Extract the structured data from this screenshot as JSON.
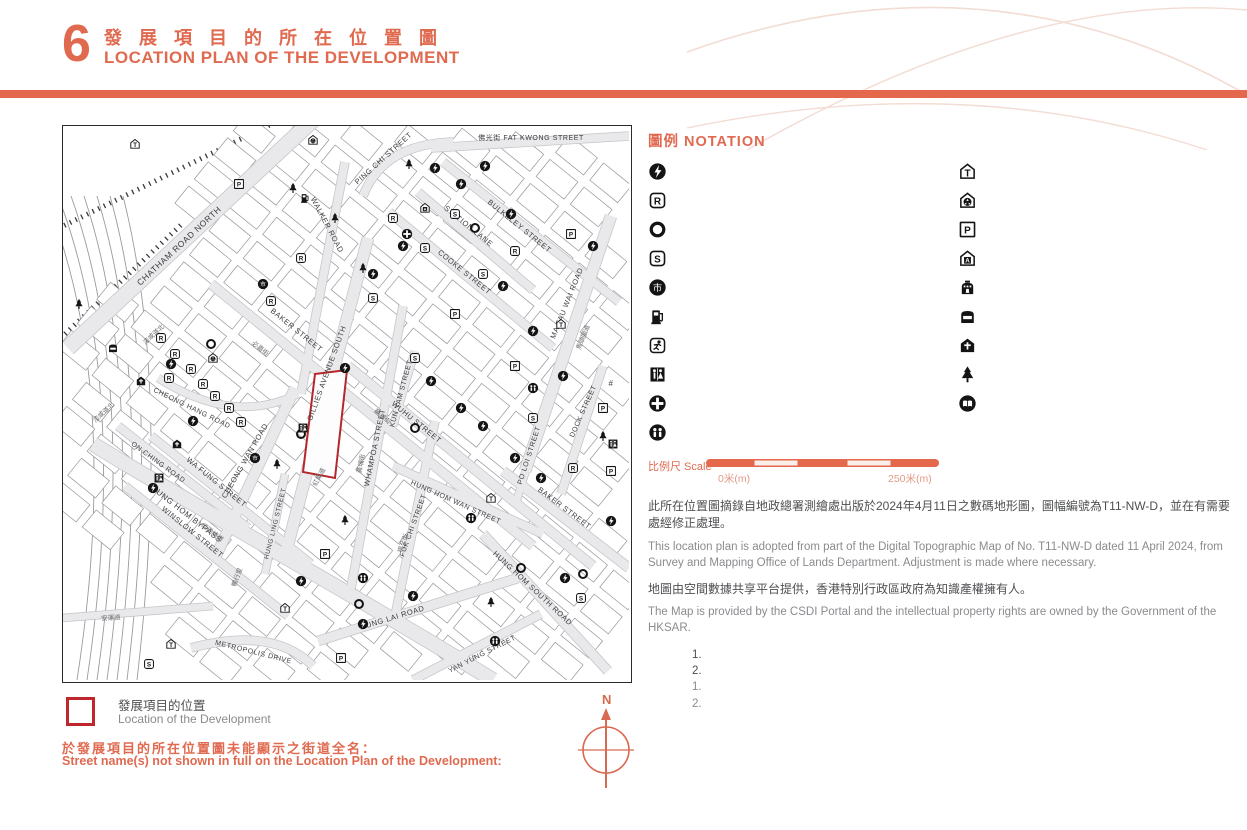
{
  "page": {
    "number": "6",
    "title_zh": "發 展 項 目 的 所 在 位 置 圖",
    "title_en": "LOCATION PLAN OF THE DEVELOPMENT"
  },
  "colors": {
    "accent": "#e06a50",
    "bar": "#e4694c",
    "site_red": "#b5272b",
    "key_red": "#c0272d"
  },
  "notation": {
    "title": "圖例 NOTATION",
    "columns": [
      [
        {
          "icon": "power",
          "zh": "發電廠（包括電力分站）",
          "en": "Power Plant (including Electricity Sub-stations)"
        },
        {
          "icon": "religious",
          "zh": "宗教場所（包括教堂、廟宇及祠堂）",
          "en": "Religious Institution (including Church, Temple and Tsz Tong)"
        },
        {
          "icon": "utility",
          "zh": "公用事業設施裝置",
          "en": "Public Utility Installation"
        },
        {
          "icon": "school",
          "zh": "學校（包括幼稚園）",
          "en": "School (including Kindergarten)"
        },
        {
          "icon": "market",
          "zh": "市場（包括濕貨市場及批發市場）",
          "en": "Market (including Wet Market and Wholesale Market)"
        },
        {
          "icon": "petrol",
          "zh": "油站",
          "en": "Petrol Filling Station"
        },
        {
          "icon": "sports",
          "zh": "體育設施（包括運動場及游泳池）",
          "en": "Sports Facilities (including Sports Ground and Swimming Pool)"
        },
        {
          "icon": "toilet",
          "zh": "公廁",
          "en": "Public Convenience"
        },
        {
          "icon": "clinic",
          "zh": "診療所",
          "en": "Clinic"
        },
        {
          "icon": "welfare",
          "zh": "社會福利設施（包括老人中心及弱智人士護理院）",
          "en": "Social Welfare Facilities (including Elderly Centre and Home for the Mentally Disabled)"
        }
      ],
      [
        {
          "icon": "transport",
          "zh": "公共交通總站（包括鐵路車站）",
          "en": "Public Transport Terminal (including Rail Station)"
        },
        {
          "icon": "refuse",
          "zh": "垃圾收集站",
          "en": "Refuse Collection Point"
        },
        {
          "icon": "carpark",
          "zh": "公眾停車場（包括貨車停泊處）",
          "en": "Public Carpark (including Lorry Park)"
        },
        {
          "icon": "addiction",
          "zh": "戒毒院所",
          "en": "Addiction Treatment Centre"
        },
        {
          "icon": "columbarium",
          "zh": "骨灰龕",
          "en": "Columbarium"
        },
        {
          "icon": "mortuary",
          "zh": "殮房",
          "en": "Mortuary"
        },
        {
          "icon": "funeral",
          "zh": "殯儀館",
          "en": "Funeral Parlour"
        },
        {
          "icon": "park",
          "zh": "公園",
          "en": "Public Park"
        },
        {
          "icon": "library",
          "zh": "圖書館",
          "en": "Library"
        }
      ]
    ]
  },
  "scale": {
    "label": "比例尺 Scale",
    "start": "0米(m)",
    "end": "250米(m)"
  },
  "source": {
    "para1_zh": "此所在位置圖摘錄自地政總署測繪處出版於2024年4月11日之數碼地形圖，圖幅編號為T11-NW-D，並在有需要處經修正處理。",
    "para1_en": "This location plan is adopted from part of the Digital Topographic Map of No. T11-NW-D dated 11 April 2024, from Survey and Mapping Office of Lands Department. Adjustment is made where necessary.",
    "para2_zh": "地圖由空間數據共享平台提供，香港特別行政區政府為知識產權擁有人。",
    "para2_en": "The Map is provided by the CSDI Portal and the intellectual property rights are owned by the Government of the HKSAR."
  },
  "notes": {
    "label_zh": "備註：",
    "label_en": "Notes:",
    "zh": [
      "因技術性問題，此所在位置圖顯示的範圍超過《一手住宅物業銷售條例》的規定。",
      "賣方建議準買家到發展項目作實地考察，以對發展項目、其周邊地區環境及附近的公共設施有較佳了解。"
    ],
    "en": [
      "Due to technical reasons, this location plan has shown more than the area required under the Residential Properties (First-hand Sales) Ordinance.",
      "The Vendor advises prospective purchasers to conduct an on-site visit for a better understanding of the Development, its surrounding environment and the public facilities nearby."
    ]
  },
  "dev_location": {
    "zh": "發展項目的位置",
    "en": "Location of the Development"
  },
  "street_names": {
    "heading_zh": "於發展項目的所在位置圖未能顯示之街道全名：",
    "heading_en": "Street name(s) not shown in full on the Location Plan of the Development:",
    "columns": [
      [
        {
          "zh": "#德民街",
          "en": "Tak Man Street"
        },
        {
          "zh": "暢行里",
          "en": "Cheong Hang Lane"
        },
        {
          "zh": "孖庶街",
          "en": "Marsh Street"
        },
        {
          "zh": "湖光街",
          "en": "Wu Kwong Street"
        }
      ],
      [
        {
          "zh": "紅樂道",
          "en": "Hung Lok Road"
        },
        {
          "zh": "必嘉圍",
          "en": "Baker Court"
        },
        {
          "zh": "大沽街",
          "en": "Taku Street"
        },
        {
          "zh": "安運道",
          "en": "On Wan Road"
        }
      ],
      [
        {
          "zh": "暢通道南",
          "en": "Cheong Tung Road South"
        },
        {
          "zh": "馬來街",
          "en": "Malacca Street"
        },
        {
          "zh": "明安街",
          "en": "Ming On Street"
        }
      ]
    ]
  },
  "compass": {
    "label": "N"
  },
  "map": {
    "streets": [
      {
        "t": "CHATHAM ROAD NORTH",
        "x": 118,
        "y": 122,
        "r": -43,
        "s": 8.5
      },
      {
        "t": "PING CHI STREET",
        "x": 322,
        "y": 34,
        "r": -42,
        "s": 7.5
      },
      {
        "t": "佛光街 FAT KWONG STREET",
        "x": 468,
        "y": 14,
        "r": 0,
        "s": 7
      },
      {
        "t": "BULKELEY STREET",
        "x": 455,
        "y": 102,
        "r": 39,
        "s": 7.5
      },
      {
        "t": "COOKE STREET",
        "x": 400,
        "y": 148,
        "r": 39,
        "s": 7.5
      },
      {
        "t": "BAKER STREET",
        "x": 232,
        "y": 206,
        "r": 39,
        "s": 7.5
      },
      {
        "t": "STATION LANE",
        "x": 404,
        "y": 102,
        "r": 39,
        "s": 7.5
      },
      {
        "t": "WALKER ROAD",
        "x": 262,
        "y": 100,
        "r": 62,
        "s": 7.5
      },
      {
        "t": "WUHU STREET",
        "x": 352,
        "y": 298,
        "r": 39,
        "s": 7.5
      },
      {
        "t": "WA FUNG STREET",
        "x": 152,
        "y": 358,
        "r": 39,
        "s": 7.5
      },
      {
        "t": "WINSLOW STREET",
        "x": 128,
        "y": 408,
        "r": 39,
        "s": 7.5
      },
      {
        "t": "KUN YAM STREET",
        "x": 340,
        "y": 268,
        "r": -75,
        "s": 7
      },
      {
        "t": "MA TAU WAI ROAD",
        "x": 506,
        "y": 178,
        "r": -68,
        "s": 7.5
      },
      {
        "t": "DOCK STREET",
        "x": 522,
        "y": 286,
        "r": -66,
        "s": 7
      },
      {
        "t": "GILLIES AVENUE SOUTH",
        "x": 266,
        "y": 248,
        "r": -70,
        "s": 7.5
      },
      {
        "t": "WHAMPOA STREET",
        "x": 314,
        "y": 322,
        "r": -78,
        "s": 7.5
      },
      {
        "t": "FUK CHI STREET",
        "x": 352,
        "y": 400,
        "r": -70,
        "s": 7
      },
      {
        "t": "PO LOI STREET",
        "x": 468,
        "y": 330,
        "r": -72,
        "s": 7
      },
      {
        "t": "BAKER STREET",
        "x": 500,
        "y": 384,
        "r": 37,
        "s": 7.5
      },
      {
        "t": "HUNG HOM WAN STREET",
        "x": 392,
        "y": 378,
        "r": 24,
        "s": 7
      },
      {
        "t": "HUNG HOM SOUTH ROAD",
        "x": 468,
        "y": 464,
        "r": 43,
        "s": 7.5
      },
      {
        "t": "HUNG LAI ROAD",
        "x": 330,
        "y": 494,
        "r": -17,
        "s": 7.5
      },
      {
        "t": "YAN YUNG STREET",
        "x": 420,
        "y": 530,
        "r": -27,
        "s": 7
      },
      {
        "t": "METROPOLIS DRIVE",
        "x": 190,
        "y": 528,
        "r": 14,
        "s": 7
      },
      {
        "t": "HUNG HOM BYPASS",
        "x": 122,
        "y": 390,
        "r": 38,
        "s": 8
      },
      {
        "t": "ON CHING ROAD",
        "x": 94,
        "y": 338,
        "r": 36,
        "s": 7
      },
      {
        "t": "CHEONG WAN ROAD",
        "x": 184,
        "y": 336,
        "r": -60,
        "s": 7.5
      },
      {
        "t": "CHEONG HANG ROAD",
        "x": 128,
        "y": 284,
        "r": 26,
        "s": 7
      },
      {
        "t": "HUNG LING STREET",
        "x": 214,
        "y": 398,
        "r": -76,
        "s": 6.5
      },
      {
        "t": "#",
        "x": 548,
        "y": 260,
        "r": 0,
        "s": 8
      }
    ],
    "streets_zh": [
      {
        "t": "漆咸道北",
        "x": 92,
        "y": 210,
        "r": -43,
        "s": 6.5
      },
      {
        "t": "漆咸道北",
        "x": 42,
        "y": 288,
        "r": -43,
        "s": 6.5
      },
      {
        "t": "必嘉街",
        "x": 196,
        "y": 224,
        "r": 39,
        "s": 6.5
      },
      {
        "t": "蕪湖街",
        "x": 318,
        "y": 292,
        "r": 39,
        "s": 6.5
      },
      {
        "t": "黃埔街",
        "x": 300,
        "y": 338,
        "r": -78,
        "s": 6.5
      },
      {
        "t": "福至街",
        "x": 342,
        "y": 418,
        "r": -70,
        "s": 6.5
      },
      {
        "t": "馬頭圍道",
        "x": 522,
        "y": 212,
        "r": -68,
        "s": 6.5
      },
      {
        "t": "紅磡繞道",
        "x": 148,
        "y": 408,
        "r": 38,
        "s": 6.5
      },
      {
        "t": "紅樂道",
        "x": 258,
        "y": 352,
        "r": -62,
        "s": 6.5
      },
      {
        "t": "安運道",
        "x": 48,
        "y": 494,
        "r": -4,
        "s": 6.5
      },
      {
        "t": "暢行里",
        "x": 176,
        "y": 452,
        "r": -70,
        "s": 6.5
      }
    ],
    "icons": [
      {
        "t": "transport",
        "x": 72,
        "y": 18
      },
      {
        "t": "transport",
        "x": 498,
        "y": 198
      },
      {
        "t": "transport",
        "x": 222,
        "y": 482
      },
      {
        "t": "transport",
        "x": 108,
        "y": 518
      },
      {
        "t": "transport",
        "x": 428,
        "y": 372
      },
      {
        "t": "power",
        "x": 372,
        "y": 42
      },
      {
        "t": "power",
        "x": 398,
        "y": 58
      },
      {
        "t": "power",
        "x": 422,
        "y": 40
      },
      {
        "t": "power",
        "x": 448,
        "y": 88
      },
      {
        "t": "power",
        "x": 340,
        "y": 120
      },
      {
        "t": "power",
        "x": 310,
        "y": 148
      },
      {
        "t": "power",
        "x": 282,
        "y": 242
      },
      {
        "t": "power",
        "x": 440,
        "y": 160
      },
      {
        "t": "power",
        "x": 470,
        "y": 205
      },
      {
        "t": "power",
        "x": 500,
        "y": 250
      },
      {
        "t": "power",
        "x": 368,
        "y": 255
      },
      {
        "t": "power",
        "x": 398,
        "y": 282
      },
      {
        "t": "power",
        "x": 420,
        "y": 300
      },
      {
        "t": "power",
        "x": 452,
        "y": 332
      },
      {
        "t": "power",
        "x": 478,
        "y": 352
      },
      {
        "t": "power",
        "x": 350,
        "y": 470
      },
      {
        "t": "power",
        "x": 300,
        "y": 498
      },
      {
        "t": "power",
        "x": 90,
        "y": 362
      },
      {
        "t": "power",
        "x": 130,
        "y": 295
      },
      {
        "t": "power",
        "x": 108,
        "y": 238
      },
      {
        "t": "power",
        "x": 530,
        "y": 120
      },
      {
        "t": "power",
        "x": 548,
        "y": 395
      },
      {
        "t": "power",
        "x": 238,
        "y": 455
      },
      {
        "t": "power",
        "x": 502,
        "y": 452
      },
      {
        "t": "religious",
        "x": 98,
        "y": 212
      },
      {
        "t": "religious",
        "x": 112,
        "y": 228
      },
      {
        "t": "religious",
        "x": 128,
        "y": 243
      },
      {
        "t": "religious",
        "x": 106,
        "y": 252
      },
      {
        "t": "religious",
        "x": 140,
        "y": 258
      },
      {
        "t": "religious",
        "x": 152,
        "y": 270
      },
      {
        "t": "religious",
        "x": 166,
        "y": 282
      },
      {
        "t": "religious",
        "x": 178,
        "y": 296
      },
      {
        "t": "religious",
        "x": 238,
        "y": 132
      },
      {
        "t": "religious",
        "x": 208,
        "y": 175
      },
      {
        "t": "religious",
        "x": 330,
        "y": 92
      },
      {
        "t": "religious",
        "x": 452,
        "y": 125
      },
      {
        "t": "religious",
        "x": 510,
        "y": 342
      },
      {
        "t": "school",
        "x": 392,
        "y": 88
      },
      {
        "t": "school",
        "x": 362,
        "y": 122
      },
      {
        "t": "school",
        "x": 420,
        "y": 148
      },
      {
        "t": "school",
        "x": 310,
        "y": 172
      },
      {
        "t": "school",
        "x": 470,
        "y": 292
      },
      {
        "t": "school",
        "x": 518,
        "y": 472
      },
      {
        "t": "school",
        "x": 86,
        "y": 538
      },
      {
        "t": "school",
        "x": 352,
        "y": 232
      },
      {
        "t": "carpark",
        "x": 176,
        "y": 58
      },
      {
        "t": "carpark",
        "x": 392,
        "y": 188
      },
      {
        "t": "carpark",
        "x": 508,
        "y": 108
      },
      {
        "t": "carpark",
        "x": 452,
        "y": 240
      },
      {
        "t": "carpark",
        "x": 540,
        "y": 282
      },
      {
        "t": "carpark",
        "x": 262,
        "y": 428
      },
      {
        "t": "carpark",
        "x": 278,
        "y": 532
      },
      {
        "t": "carpark",
        "x": 548,
        "y": 345
      },
      {
        "t": "utility",
        "x": 148,
        "y": 218
      },
      {
        "t": "utility",
        "x": 238,
        "y": 308
      },
      {
        "t": "utility",
        "x": 412,
        "y": 102
      },
      {
        "t": "utility",
        "x": 352,
        "y": 302
      },
      {
        "t": "utility",
        "x": 458,
        "y": 442
      },
      {
        "t": "utility",
        "x": 296,
        "y": 478
      },
      {
        "t": "utility",
        "x": 520,
        "y": 448
      },
      {
        "t": "market",
        "x": 200,
        "y": 158
      },
      {
        "t": "market",
        "x": 192,
        "y": 332
      },
      {
        "t": "toilet",
        "x": 96,
        "y": 352
      },
      {
        "t": "toilet",
        "x": 240,
        "y": 302
      },
      {
        "t": "toilet",
        "x": 550,
        "y": 318
      },
      {
        "t": "clinic",
        "x": 344,
        "y": 108
      },
      {
        "t": "welfare",
        "x": 470,
        "y": 262
      },
      {
        "t": "welfare",
        "x": 408,
        "y": 392
      },
      {
        "t": "welfare",
        "x": 300,
        "y": 452
      },
      {
        "t": "welfare",
        "x": 432,
        "y": 515
      },
      {
        "t": "petrol",
        "x": 242,
        "y": 72
      },
      {
        "t": "park",
        "x": 230,
        "y": 62
      },
      {
        "t": "park",
        "x": 272,
        "y": 92
      },
      {
        "t": "park",
        "x": 16,
        "y": 178
      },
      {
        "t": "park",
        "x": 346,
        "y": 38
      },
      {
        "t": "park",
        "x": 214,
        "y": 338
      },
      {
        "t": "park",
        "x": 282,
        "y": 394
      },
      {
        "t": "park",
        "x": 540,
        "y": 310
      },
      {
        "t": "park",
        "x": 428,
        "y": 476
      },
      {
        "t": "park",
        "x": 300,
        "y": 142
      },
      {
        "t": "refuse",
        "x": 250,
        "y": 14
      },
      {
        "t": "refuse",
        "x": 150,
        "y": 232
      },
      {
        "t": "funeral",
        "x": 114,
        "y": 318
      },
      {
        "t": "funeral",
        "x": 78,
        "y": 255
      },
      {
        "t": "mortuary",
        "x": 50,
        "y": 222
      },
      {
        "t": "addiction",
        "x": 362,
        "y": 82
      }
    ],
    "site": "252,248 284,244 272,352 240,346"
  }
}
